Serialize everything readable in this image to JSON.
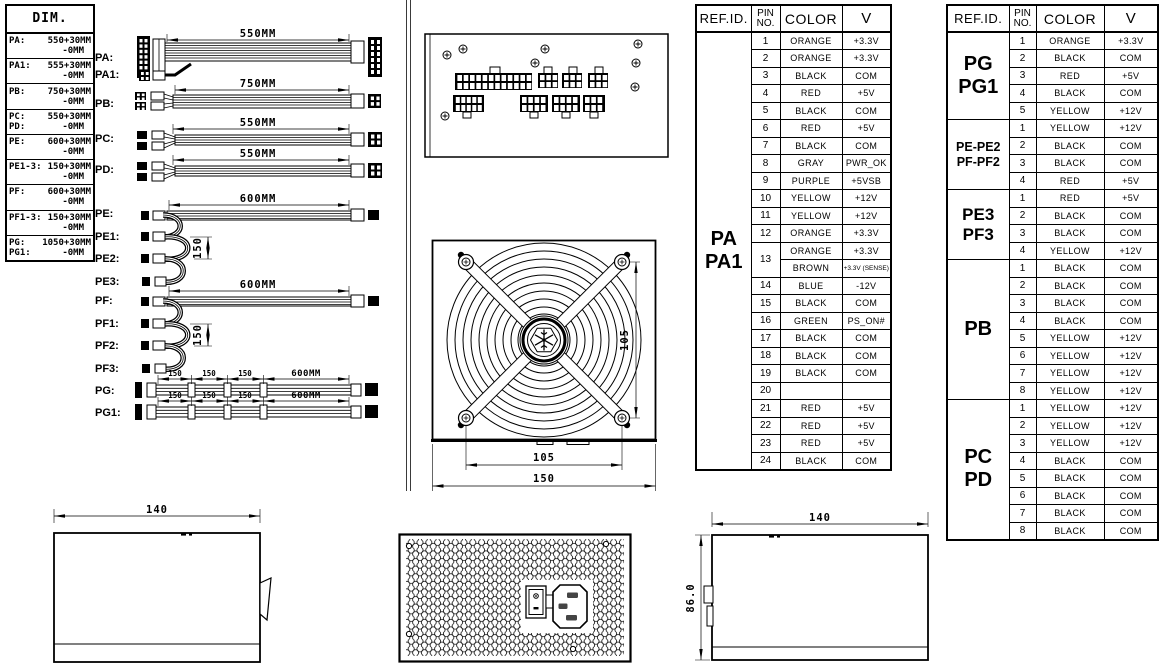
{
  "palette": {
    "ink": "#000000",
    "paper": "#ffffff"
  },
  "dim_table": {
    "title": "DIM.",
    "rows": [
      {
        "id": "PA:",
        "value": "550+30MM",
        "tol": "-0MM"
      },
      {
        "id": "PA1:",
        "value": "555+30MM",
        "tol": "-0MM"
      },
      {
        "id": "PB:",
        "value": "750+30MM",
        "tol": "-0MM"
      },
      {
        "id": "PC:",
        "value": "550+30MM",
        "id2": "PD:",
        "tol": "-0MM"
      },
      {
        "id": "PE:",
        "value": "600+30MM",
        "tol": "-0MM"
      },
      {
        "id": "PE1-3:",
        "value": "150+30MM",
        "tol": "-0MM"
      },
      {
        "id": "PF:",
        "value": "600+30MM",
        "tol": "-0MM"
      },
      {
        "id": "PF1-3:",
        "value": "150+30MM",
        "tol": "-0MM"
      },
      {
        "id": "PG:",
        "value": "1050+30MM",
        "id2": "PG1:",
        "tol": "-0MM"
      }
    ]
  },
  "cables": {
    "rows": [
      {
        "label": "PA:",
        "dim": "550MM"
      },
      {
        "label": "PA1:"
      },
      {
        "label": "PB:",
        "dim": "750MM"
      },
      {
        "label": "PC:",
        "dim": "550MM"
      },
      {
        "label": "PD:",
        "dim": "550MM"
      },
      {
        "label": "PE:",
        "dim": "600MM"
      },
      {
        "label": "PE1:"
      },
      {
        "label": "PE2:",
        "loop_dim": "150"
      },
      {
        "label": "PE3:"
      },
      {
        "label": "PF:",
        "dim": "600MM"
      },
      {
        "label": "PF1:"
      },
      {
        "label": "PF2:",
        "loop_dim": "150"
      },
      {
        "label": "PF3:"
      },
      {
        "label": "PG:",
        "dim": "600MM",
        "segs": [
          "150",
          "150",
          "150"
        ]
      },
      {
        "label": "PG1:",
        "dim": "600MM",
        "segs": [
          "150",
          "150",
          "150"
        ]
      }
    ]
  },
  "center_views": {
    "fan": {
      "dim_side": "105",
      "dim_bottom": "105",
      "dim_width": "150"
    }
  },
  "bottom_views": {
    "left": {
      "width": "140"
    },
    "right": {
      "width": "140",
      "height": "86.0"
    }
  },
  "pa_table": {
    "headers": {
      "ref": "REF.ID.",
      "pin": "PIN\nNO.",
      "color": "COLOR",
      "v": "V"
    },
    "ref_label": "PA\nPA1",
    "rows": [
      {
        "pin": "1",
        "color": "ORANGE",
        "v": "+3.3V"
      },
      {
        "pin": "2",
        "color": "ORANGE",
        "v": "+3.3V"
      },
      {
        "pin": "3",
        "color": "BLACK",
        "v": "COM"
      },
      {
        "pin": "4",
        "color": "RED",
        "v": "+5V"
      },
      {
        "pin": "5",
        "color": "BLACK",
        "v": "COM"
      },
      {
        "pin": "6",
        "color": "RED",
        "v": "+5V"
      },
      {
        "pin": "7",
        "color": "BLACK",
        "v": "COM"
      },
      {
        "pin": "8",
        "color": "GRAY",
        "v": "PWR_OK"
      },
      {
        "pin": "9",
        "color": "PURPLE",
        "v": "+5VSB"
      },
      {
        "pin": "10",
        "color": "YELLOW",
        "v": "+12V"
      },
      {
        "pin": "11",
        "color": "YELLOW",
        "v": "+12V"
      },
      {
        "pin": "12",
        "color": "ORANGE",
        "v": "+3.3V"
      },
      {
        "pin": "13",
        "color": "ORANGE",
        "v": "+3.3V"
      },
      {
        "pin": "",
        "color": "BROWN",
        "v": "+3.3V (SENSE)"
      },
      {
        "pin": "14",
        "color": "BLUE",
        "v": "-12V"
      },
      {
        "pin": "15",
        "color": "BLACK",
        "v": "COM"
      },
      {
        "pin": "16",
        "color": "GREEN",
        "v": "PS_ON#"
      },
      {
        "pin": "17",
        "color": "BLACK",
        "v": "COM"
      },
      {
        "pin": "18",
        "color": "BLACK",
        "v": "COM"
      },
      {
        "pin": "19",
        "color": "BLACK",
        "v": "COM"
      },
      {
        "pin": "20",
        "color": "",
        "v": ""
      },
      {
        "pin": "21",
        "color": "RED",
        "v": "+5V"
      },
      {
        "pin": "22",
        "color": "RED",
        "v": "+5V"
      },
      {
        "pin": "23",
        "color": "RED",
        "v": "+5V"
      },
      {
        "pin": "24",
        "color": "BLACK",
        "v": "COM"
      }
    ]
  },
  "right_table": {
    "headers": {
      "ref": "REF.ID.",
      "pin": "PIN\nNO.",
      "color": "COLOR",
      "v": "V"
    },
    "sections": [
      {
        "ref": "PG\nPG1",
        "rows": [
          {
            "pin": "1",
            "color": "ORANGE",
            "v": "+3.3V"
          },
          {
            "pin": "2",
            "color": "BLACK",
            "v": "COM"
          },
          {
            "pin": "3",
            "color": "RED",
            "v": "+5V"
          },
          {
            "pin": "4",
            "color": "BLACK",
            "v": "COM"
          },
          {
            "pin": "5",
            "color": "YELLOW",
            "v": "+12V"
          }
        ]
      },
      {
        "ref": "PE-PE2\nPF-PF2",
        "rows": [
          {
            "pin": "1",
            "color": "YELLOW",
            "v": "+12V"
          },
          {
            "pin": "2",
            "color": "BLACK",
            "v": "COM"
          },
          {
            "pin": "3",
            "color": "BLACK",
            "v": "COM"
          },
          {
            "pin": "4",
            "color": "RED",
            "v": "+5V"
          }
        ]
      },
      {
        "ref": "PE3\nPF3",
        "rows": [
          {
            "pin": "1",
            "color": "RED",
            "v": "+5V"
          },
          {
            "pin": "2",
            "color": "BLACK",
            "v": "COM"
          },
          {
            "pin": "3",
            "color": "BLACK",
            "v": "COM"
          },
          {
            "pin": "4",
            "color": "YELLOW",
            "v": "+12V"
          }
        ]
      },
      {
        "ref": "PB",
        "rows": [
          {
            "pin": "1",
            "color": "BLACK",
            "v": "COM"
          },
          {
            "pin": "2",
            "color": "BLACK",
            "v": "COM"
          },
          {
            "pin": "3",
            "color": "BLACK",
            "v": "COM"
          },
          {
            "pin": "4",
            "color": "BLACK",
            "v": "COM"
          },
          {
            "pin": "5",
            "color": "YELLOW",
            "v": "+12V"
          },
          {
            "pin": "6",
            "color": "YELLOW",
            "v": "+12V"
          },
          {
            "pin": "7",
            "color": "YELLOW",
            "v": "+12V"
          },
          {
            "pin": "8",
            "color": "YELLOW",
            "v": "+12V"
          }
        ]
      },
      {
        "ref": "PC\nPD",
        "rows": [
          {
            "pin": "1",
            "color": "YELLOW",
            "v": "+12V"
          },
          {
            "pin": "2",
            "color": "YELLOW",
            "v": "+12V"
          },
          {
            "pin": "3",
            "color": "YELLOW",
            "v": "+12V"
          },
          {
            "pin": "4",
            "color": "BLACK",
            "v": "COM"
          },
          {
            "pin": "5",
            "color": "BLACK",
            "v": "COM"
          },
          {
            "pin": "6",
            "color": "BLACK",
            "v": "COM"
          },
          {
            "pin": "7",
            "color": "BLACK",
            "v": "COM"
          },
          {
            "pin": "8",
            "color": "BLACK",
            "v": "COM"
          }
        ]
      }
    ]
  }
}
